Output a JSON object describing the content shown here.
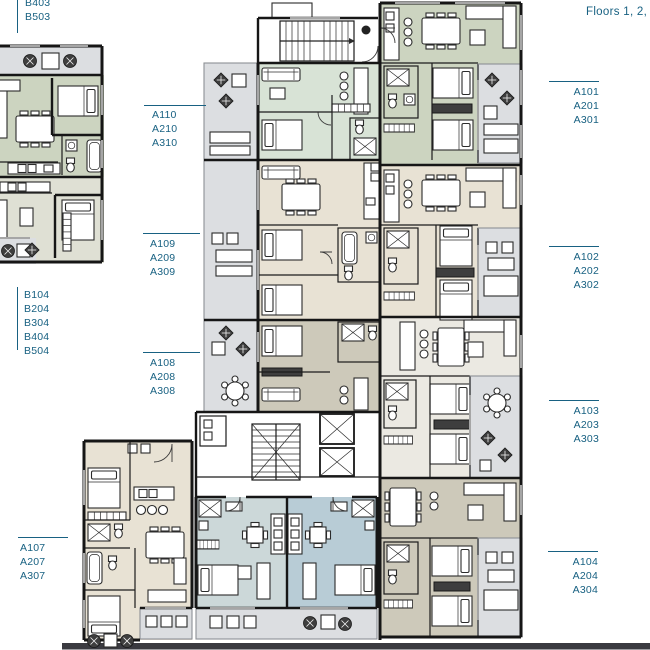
{
  "title": "Floors 1, 2, 3",
  "colors": {
    "label": "#186182",
    "sage": "#ccd4c0",
    "sage2": "#dfe0d4",
    "mint": "#d8e3d6",
    "beige": "#e8e2d4",
    "taupe": "#cdc9ba",
    "offwhite": "#ebe9e2",
    "studio1": "#ccd8d9",
    "studio2": "#b8ccd6",
    "terrace": "#dcdee1",
    "road": "#3a3a40"
  },
  "unit_labels": [
    {
      "id": "b403",
      "lines": [
        "B403",
        "B503"
      ]
    },
    {
      "id": "a110",
      "lines": [
        "A110",
        "A210",
        "A310"
      ]
    },
    {
      "id": "a109",
      "lines": [
        "A109",
        "A209",
        "A309"
      ]
    },
    {
      "id": "b104",
      "lines": [
        "B104",
        "B204",
        "B304",
        "B404",
        "B504"
      ]
    },
    {
      "id": "a108",
      "lines": [
        "A108",
        "A208",
        "A308"
      ]
    },
    {
      "id": "a107",
      "lines": [
        "A107",
        "A207",
        "A307"
      ]
    },
    {
      "id": "a101",
      "lines": [
        "A101",
        "A201",
        "A301"
      ]
    },
    {
      "id": "a102",
      "lines": [
        "A102",
        "A202",
        "A302"
      ]
    },
    {
      "id": "a103",
      "lines": [
        "A103",
        "A203",
        "A303"
      ]
    },
    {
      "id": "a104",
      "lines": [
        "A104",
        "A204",
        "A304"
      ]
    }
  ]
}
